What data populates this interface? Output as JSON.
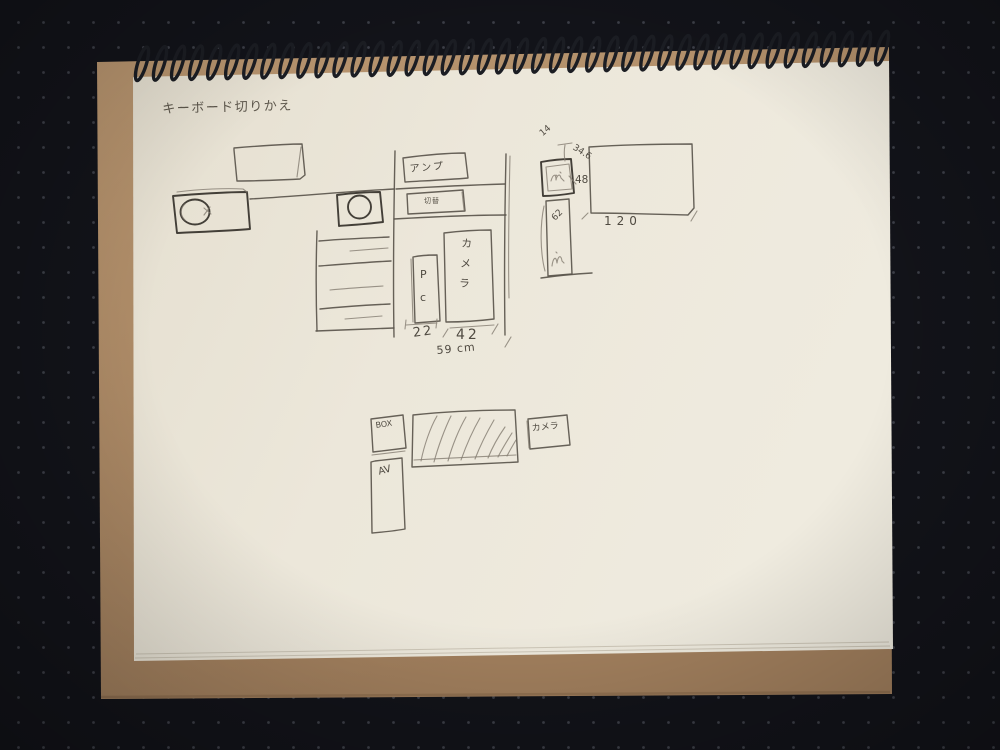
{
  "scene": {
    "description": "Photo of a spiral sketchbook on a dark dotted desk mat, with a pencil layout sketch",
    "surface_color": "#121319",
    "dot_color": "#9499a8",
    "cardboard_color": "#b3906c",
    "paper_color": "#ece7da",
    "spiral_color": "#1b1d23",
    "pencil_color": "#5a554c"
  },
  "sketch": {
    "title": "キーボード切りかえ",
    "labels": {
      "amp": "アンプ",
      "switch": "切替",
      "pc": "P\nc",
      "camera_rack": "カメラ",
      "box": "BOX",
      "av": "AV",
      "camera_shelf": "カメラ"
    },
    "dimensions": {
      "pc_width": "22",
      "camera_width": "42",
      "row_total": "59 cm",
      "desk_width": "120",
      "gap_top": "14",
      "desk_depth": "34.6",
      "monitor_height": "48",
      "column_depth": "62"
    }
  }
}
